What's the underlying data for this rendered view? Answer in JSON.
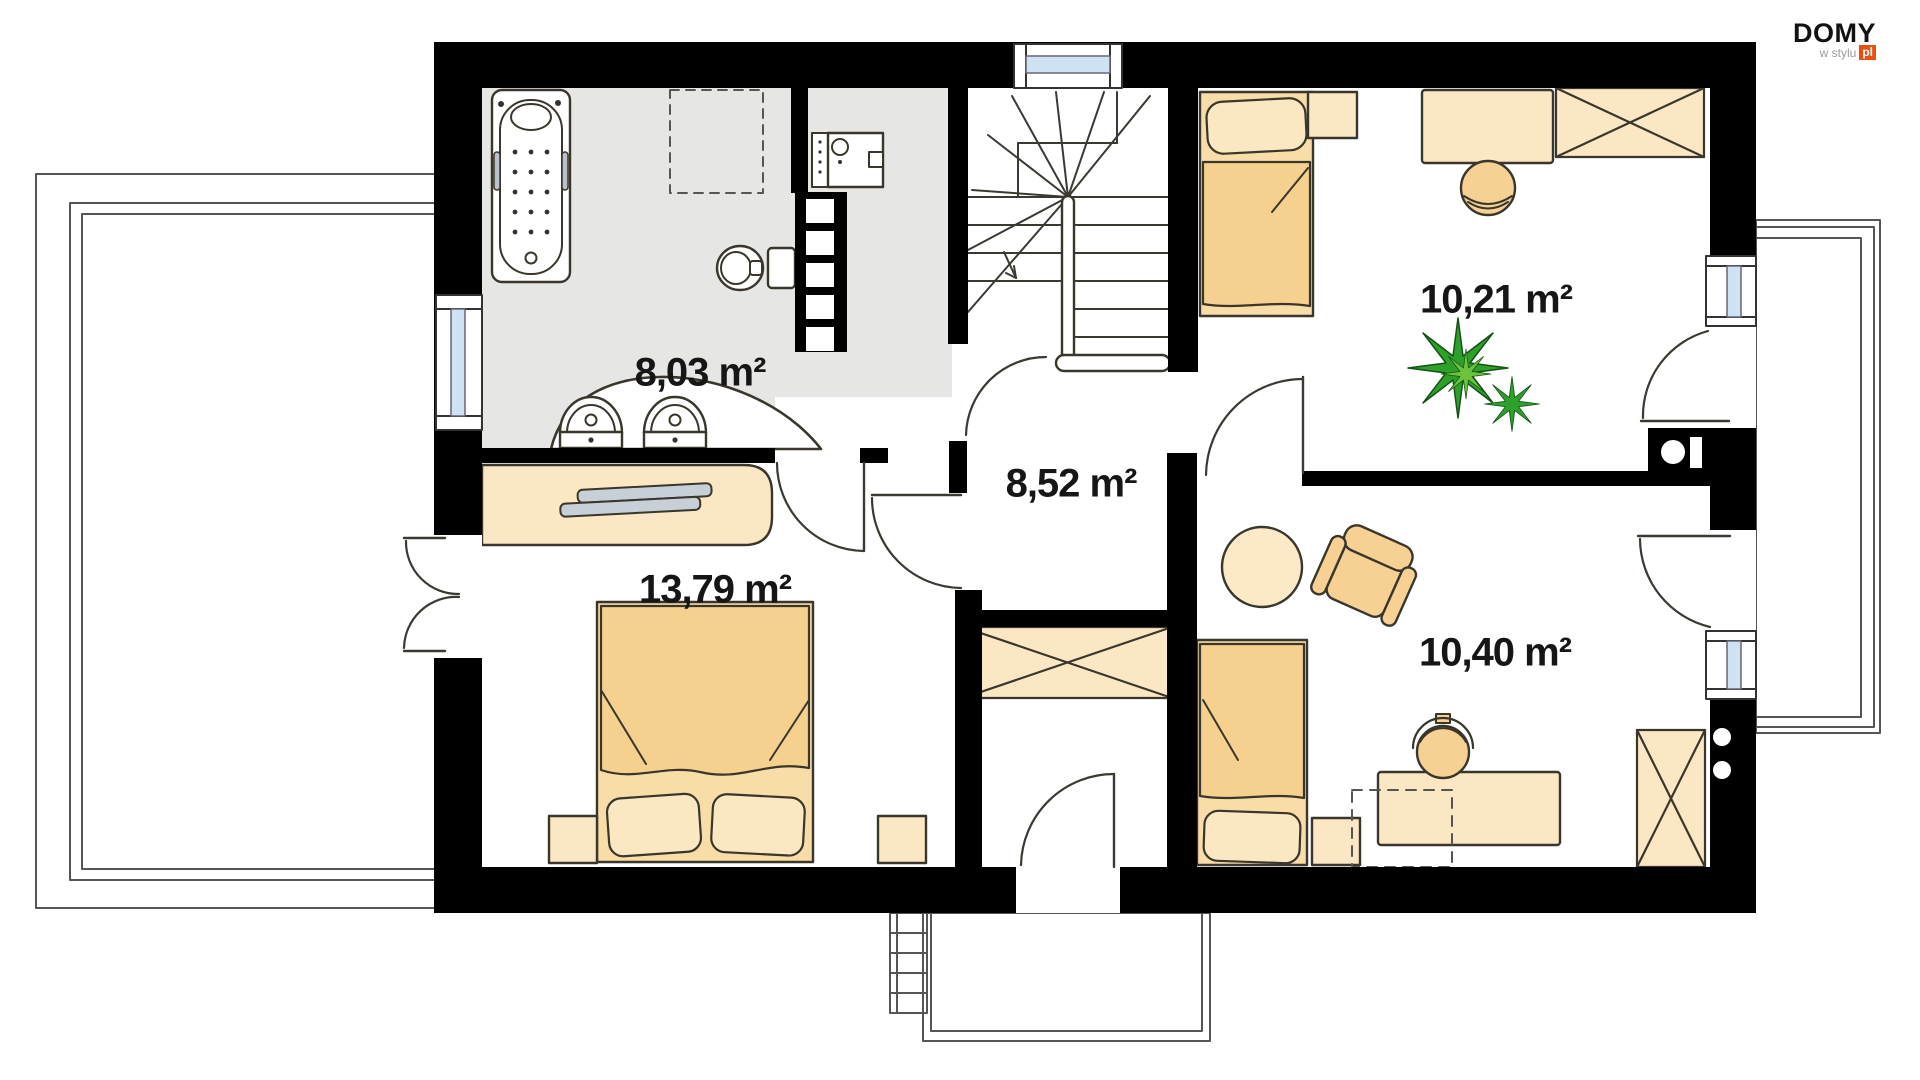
{
  "logo": {
    "brand": "DOMY",
    "tagline": "w stylu",
    "suffix": "pl",
    "accent_color": "#e8500f"
  },
  "rooms": {
    "bathroom": {
      "label": "8,03 m²"
    },
    "hallway": {
      "label": "8,52 m²"
    },
    "bedroom_main": {
      "label": "13,79 m²"
    },
    "bedroom_top_right": {
      "label": "10,21 m²"
    },
    "bedroom_bottom_right": {
      "label": "10,40 m²"
    }
  },
  "colors": {
    "wall": "#000000",
    "bathroom_floor": "#e6e6e4",
    "furniture": "#f8dda8",
    "furniture_light": "#fbe7c4",
    "blanket": "#f5d08f",
    "pillow": "#fbe8c3",
    "outline": "#3a362c",
    "glass": "#cfe2f3",
    "plant": "#2da02c",
    "logo_accent": "#e8500f"
  }
}
